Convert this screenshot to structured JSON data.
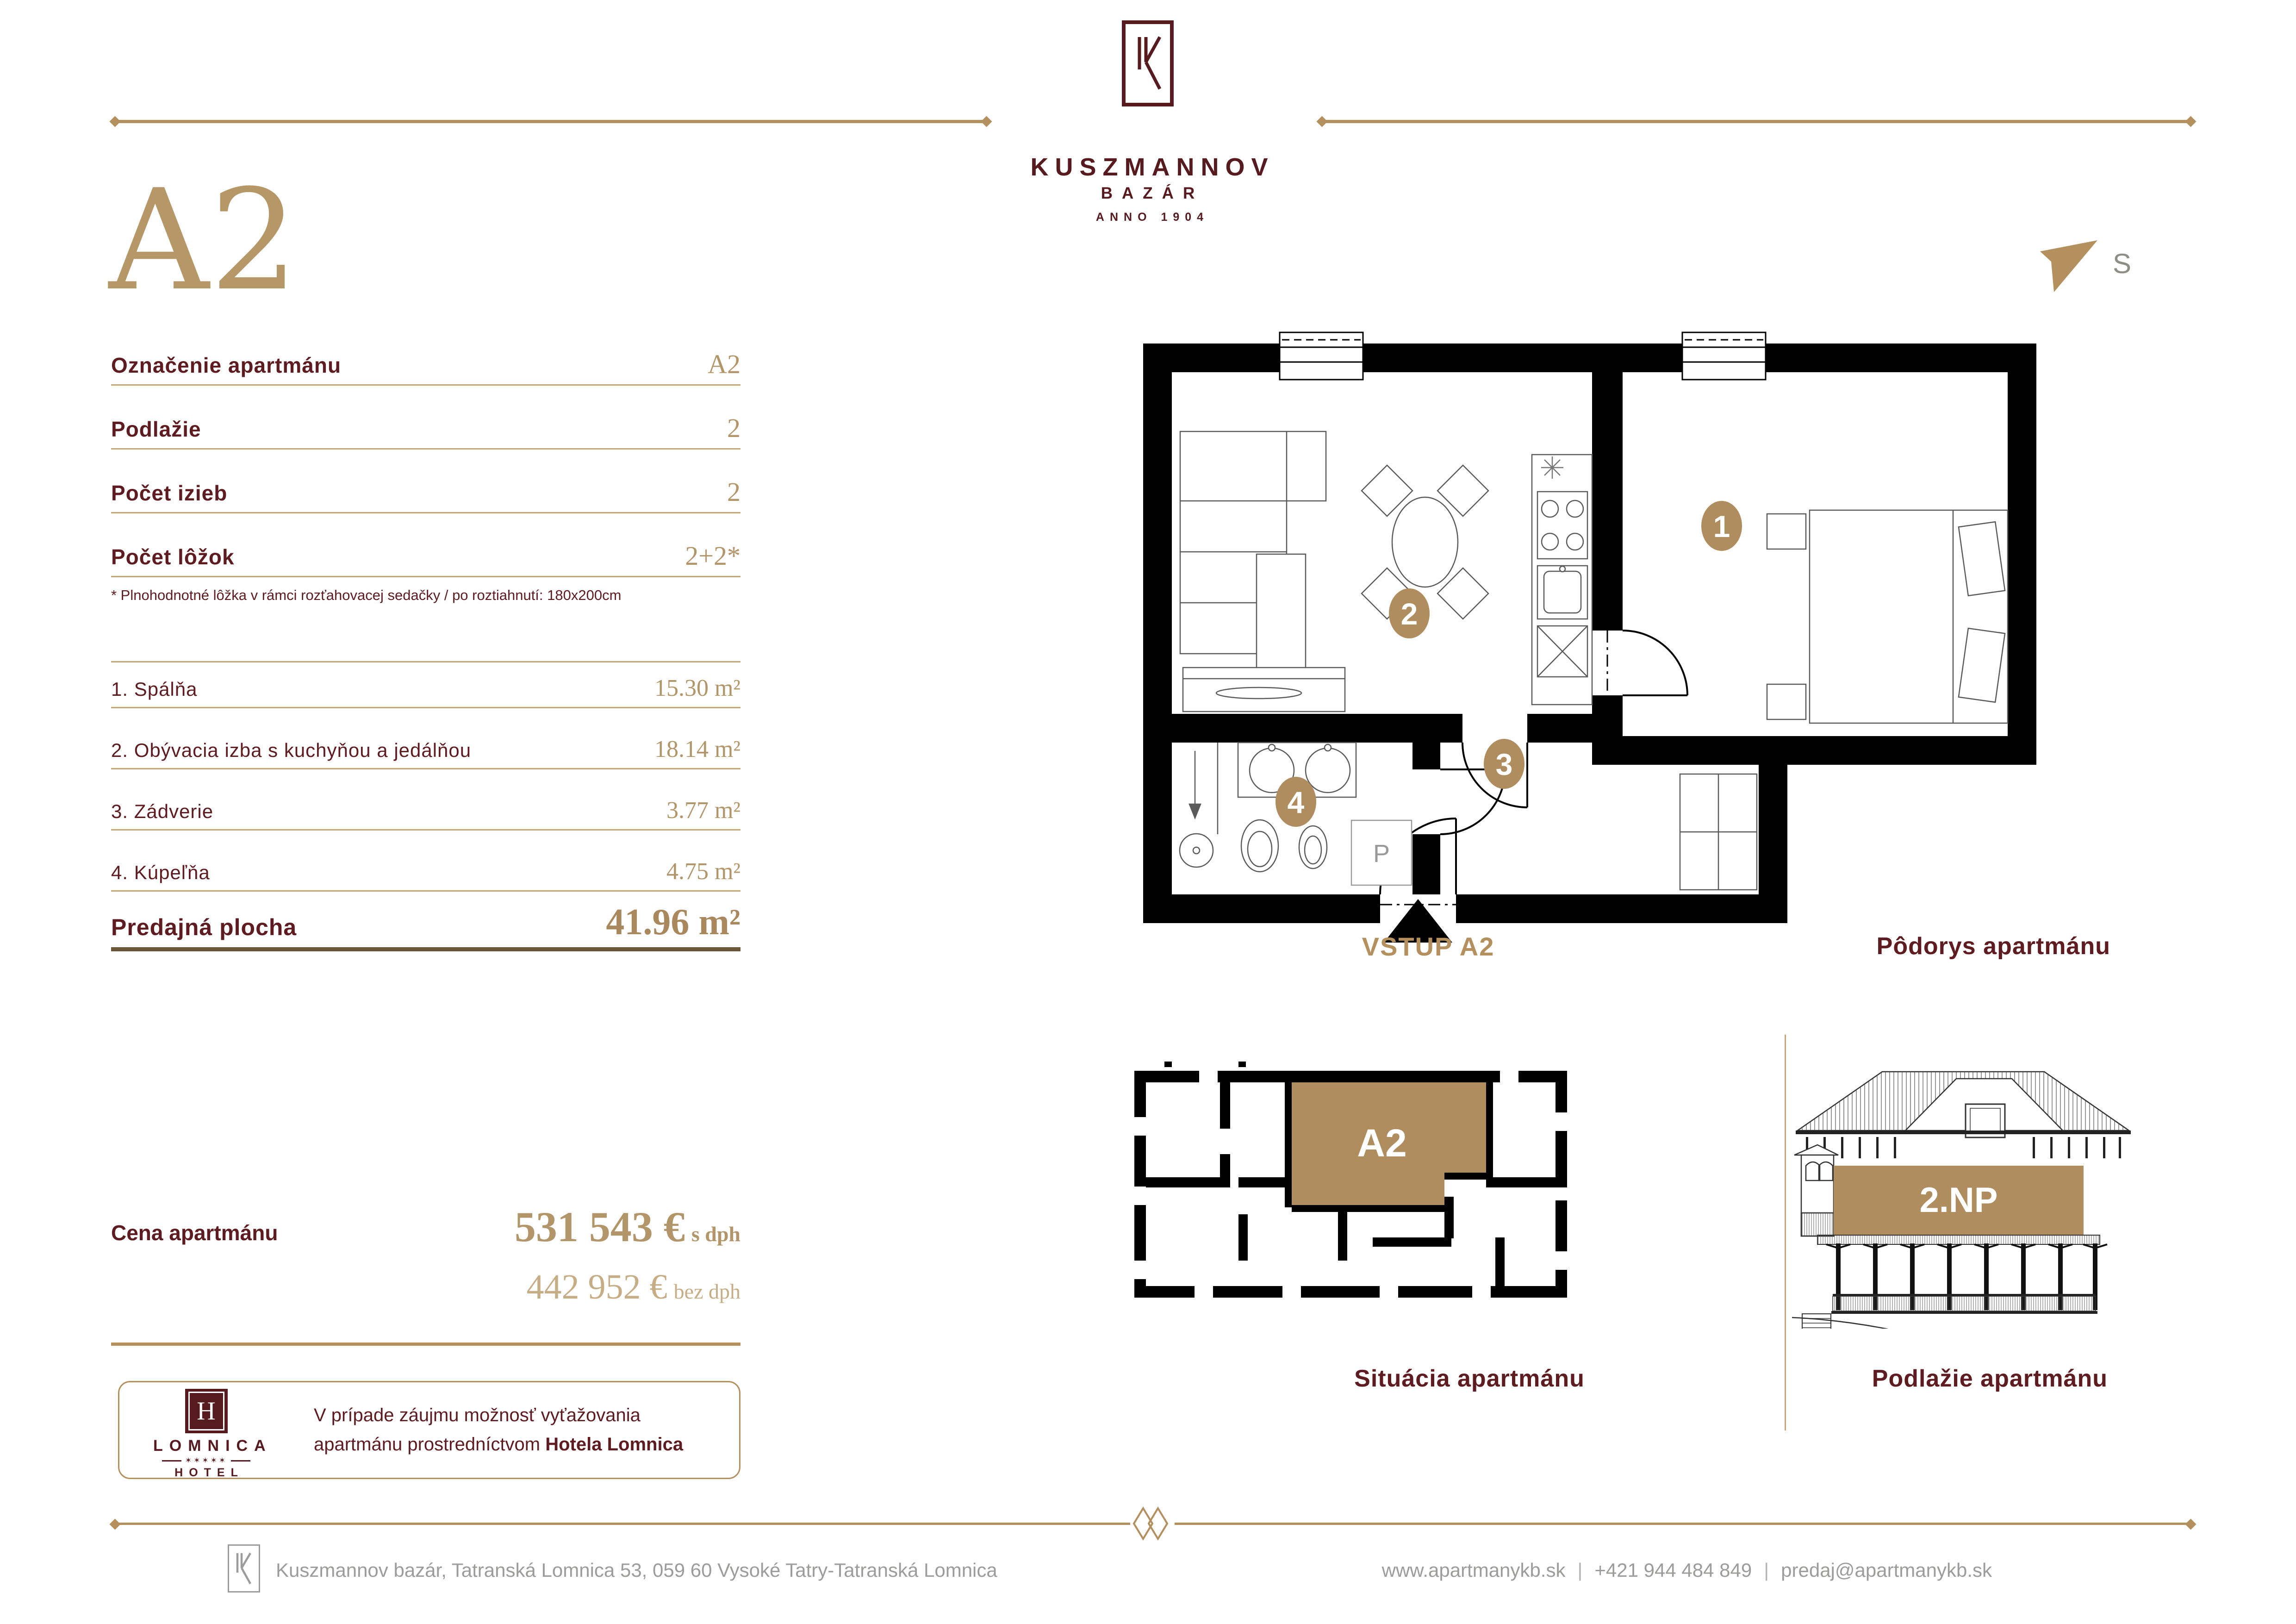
{
  "header": {
    "code": "A2",
    "brand": "KUSZMANNOV",
    "sub": "BAZÁR",
    "anno": "ANNO 1904"
  },
  "compass": {
    "label": "S"
  },
  "details": {
    "rows": [
      {
        "label": "Označenie apartmánu",
        "value": "A2"
      },
      {
        "label": "Podlažie",
        "value": "2"
      },
      {
        "label": "Počet izieb",
        "value": "2"
      },
      {
        "label": "Počet lôžok",
        "value": "2+2*"
      }
    ],
    "footnote": "* Plnohodnotné lôžka v rámci rozťahovacej sedačky / po roztiahnutí: 180x200cm"
  },
  "rooms": {
    "rows": [
      {
        "label": "1. Spálňa",
        "value": "15.30 m²"
      },
      {
        "label": "2. Obývacia izba s kuchyňou a jedálňou",
        "value": "18.14 m²"
      },
      {
        "label": "3. Zádverie",
        "value": "3.77 m²"
      },
      {
        "label": "4. Kúpeľňa",
        "value": "4.75 m²"
      }
    ],
    "total_label": "Predajná plocha",
    "total_value": "41.96 m²"
  },
  "price": {
    "label": "Cena apartmánu",
    "with_vat": "531 543 €",
    "with_vat_note": "s dph",
    "without_vat": "442 952 €",
    "without_vat_note": "bez dph"
  },
  "note": {
    "line1": "V prípade záujmu možnosť vyťažovania",
    "line2": "apartmánu prostredníctvom ",
    "line2_bold": "Hotela Lomnica"
  },
  "hotel": {
    "monogram": "H",
    "name": "LOMNICA",
    "stars": "✶✶✶✶✶",
    "type": "HOTEL"
  },
  "plan": {
    "badges": [
      "1",
      "2",
      "3",
      "4"
    ],
    "p_label": "P",
    "vstup": "VSTUP A2",
    "caption": "Pôdorys apartmánu"
  },
  "situation": {
    "label": "A2",
    "caption": "Situácia apartmánu"
  },
  "elevation": {
    "label": "2.NP",
    "caption": "Podlažie apartmánu"
  },
  "footer": {
    "monogram": "K",
    "address": "Kuszmannov bazár, Tatranská Lomnica 53, 059 60 Vysoké Tatry-Tatranská Lomnica",
    "website": "www.apartmanykb.sk",
    "separator": "|",
    "phone": "+421 944 484 849",
    "email": "predaj@apartmanykb.sk"
  },
  "colors": {
    "maroon": "#5E1B20",
    "gold": "#B4905E",
    "gold_light": "#C7AD85",
    "bronze": "#6B5639",
    "gray": "#9C9C9B",
    "wall_black": "#000000"
  }
}
